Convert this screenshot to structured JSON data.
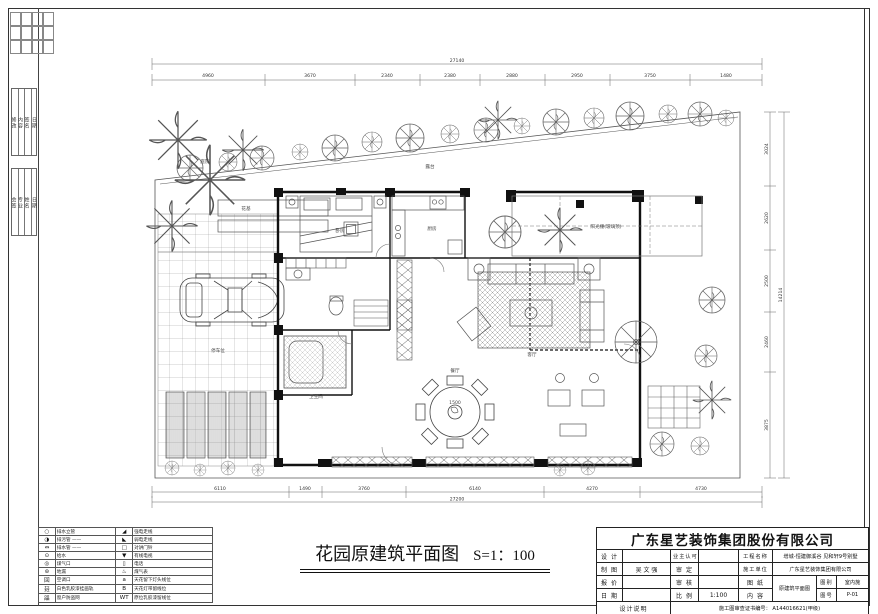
{
  "plan": {
    "title": "花园原建筑平面图",
    "scale": "S=1：100",
    "dims_top": [
      "4960",
      "3670",
      "2340",
      "2380",
      "2880",
      "2950",
      "3750",
      "1480"
    ],
    "dims_top_total": "27140",
    "dims_bottom": [
      "6110",
      "1490",
      "3760",
      "6140",
      "4270",
      "4730"
    ],
    "dims_bottom_total": "27200",
    "dims_right": [
      "3024",
      "2620",
      "2500",
      "2460",
      "3875"
    ],
    "dims_right_total": "14214",
    "labels": {
      "flower_bed": "花基",
      "courtyard": "庭院",
      "terrace": "露台",
      "sunroom": "阳光棚(玻璃顶)",
      "bedroom": "卧房",
      "kitchen": "厨房",
      "bath": "卫生间",
      "living": "客厅",
      "dining": "餐厅",
      "parking": "停车位",
      "table_dia": "1500"
    }
  },
  "legend": {
    "rows": [
      {
        "s1": "○",
        "l1": "排水立管",
        "s2": "◢",
        "l2": "强电走线"
      },
      {
        "s1": "◑",
        "l1": "排污管 ——",
        "s2": "◣",
        "l2": "弱电走线"
      },
      {
        "s1": "⇔",
        "l1": "排水管 ——",
        "s2": "□",
        "l2": "对讲门铃"
      },
      {
        "s1": "⊙",
        "l1": "给水",
        "s2": "▼",
        "l2": "有线电视"
      },
      {
        "s1": "◎",
        "l1": "煤气口",
        "s2": "▯",
        "l2": "电话"
      },
      {
        "s1": "⊚",
        "l1": "地漏",
        "s2": "♨",
        "l2": "煤气表"
      },
      {
        "s1": "回",
        "l1": "空调口",
        "s2": "a",
        "l2": "天花留下灯头线位"
      },
      {
        "s1": "㠭",
        "l1": "白色乳胶漆挂画轨",
        "s2": "B",
        "l2": "天花灯带留线位"
      },
      {
        "s1": "㗊",
        "l1": "窗户防盗网",
        "s2": "WT",
        "l2": "原位乳胶漆留线位"
      }
    ]
  },
  "margin": {
    "rev": [
      "修改",
      "内容",
      "签名",
      "日期"
    ],
    "sign": [
      "会签",
      "专业",
      "姓名",
      "日期"
    ]
  },
  "titleblock": {
    "company": "广东星艺装饰集团股份有限公司",
    "design_label": "设 计",
    "owner_label": "业主认可",
    "project_label": "工程名称",
    "project_value": "增城-恒建御溪谷 见和轩9号别墅",
    "draft_label": "制 图",
    "draft_value": "吴 文 强",
    "approve_label": "审 定",
    "unit_label": "施工单位",
    "unit_value": "广东星艺装饰集团有限公司",
    "quote_label": "报 价",
    "check_label": "审 核",
    "sheet_label": "图 纸",
    "content_label": "内 容",
    "content_value": "原建筑平面图",
    "cat_label": "图别",
    "cat_value": "室内施",
    "no_label": "图号",
    "no_value": "P-01",
    "date_label": "日 期",
    "scale_label": "比 例",
    "scale_value": "1:100",
    "note_label": "设计说明",
    "cert_label": "施工图审查证书编号：",
    "cert_value": "A144016621(甲级)"
  }
}
